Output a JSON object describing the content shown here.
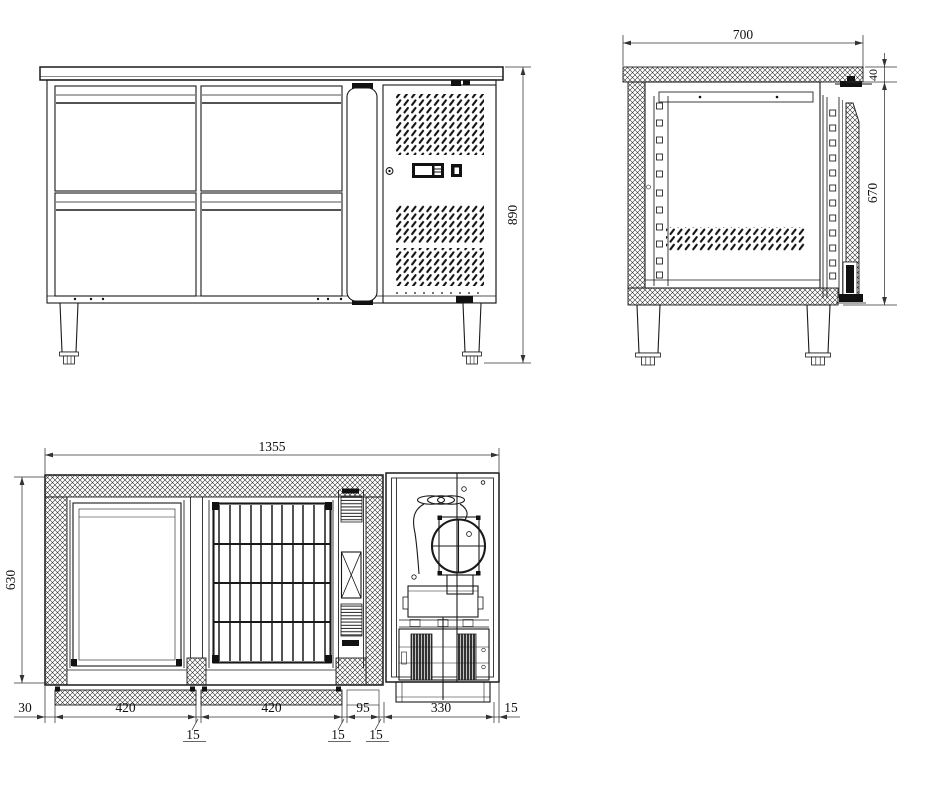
{
  "dimensions": {
    "front_view": {
      "overall_height": "890"
    },
    "side_view": {
      "overall_depth": "700",
      "countertop_thickness": "40",
      "body_height": "670"
    },
    "plan_view": {
      "overall_width": "1355",
      "interior_depth": "630",
      "bottom_chain": {
        "left_wall": "30",
        "bay_1": "420",
        "gap_1": "15",
        "bay_2": "420",
        "gap_2": "15",
        "evaporator_bay": "95",
        "gap_3": "15",
        "machine_bay": "330",
        "right_wall": "15"
      }
    }
  },
  "colors": {
    "line": "#1a1a1a",
    "background": "#ffffff"
  }
}
